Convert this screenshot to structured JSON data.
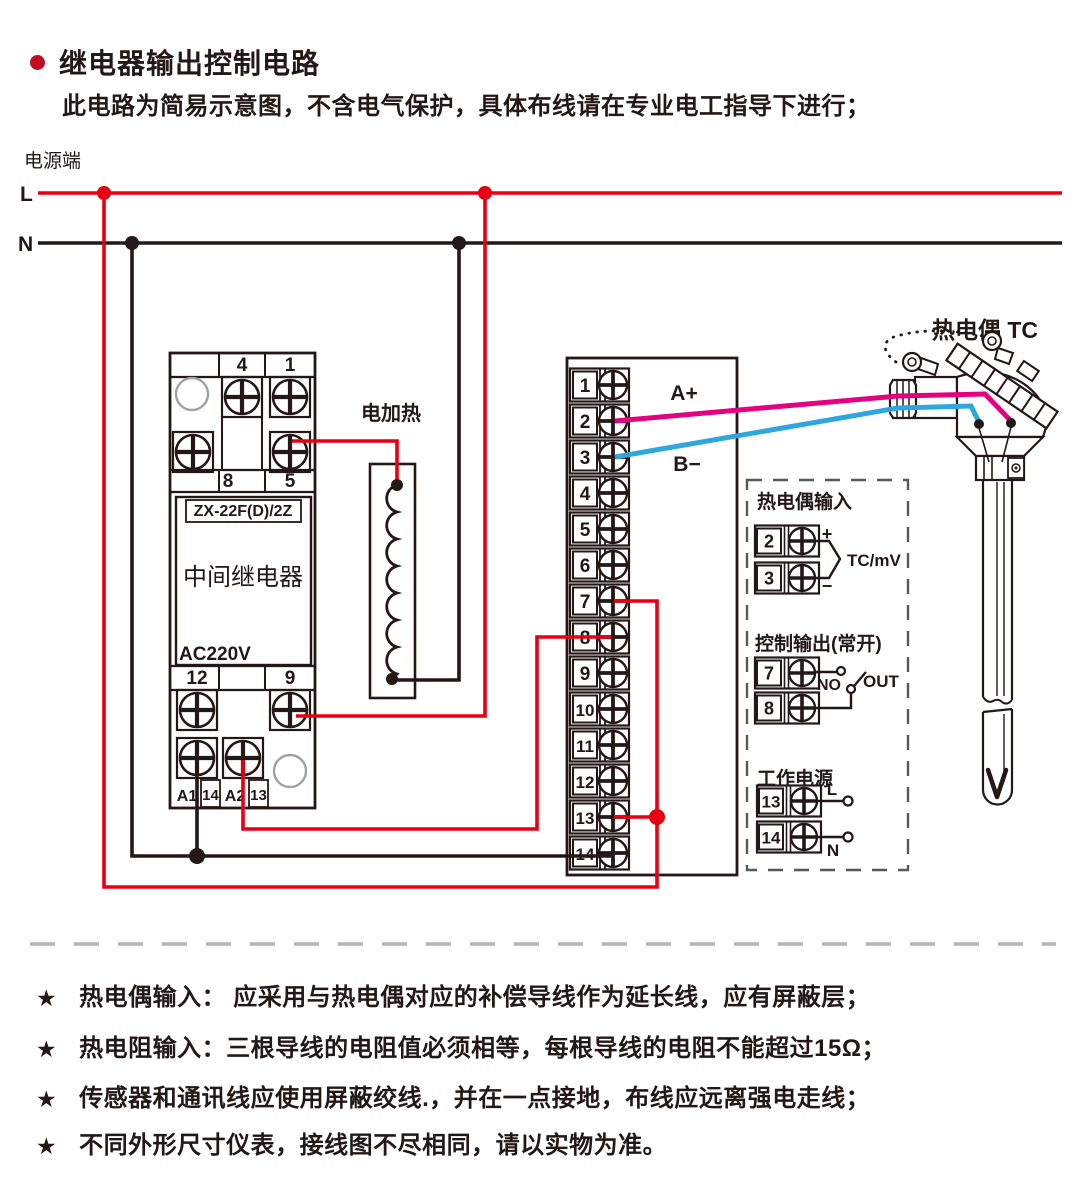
{
  "header": {
    "title": "继电器输出控制电路",
    "subtitle": "此电路为简易示意图，不含电气保护，具体布线请在专业电工指导下进行；"
  },
  "power": {
    "source_label": "电源端",
    "l": "L",
    "n": "N"
  },
  "relay": {
    "model": "ZX-22F(D)/2Z",
    "name": "中间继电器",
    "voltage": "AC220V",
    "top": [
      "4",
      "1"
    ],
    "mid": [
      "8",
      "5"
    ],
    "bottom": [
      "12",
      "9"
    ],
    "coil": [
      "A1",
      "14",
      "A2",
      "13"
    ]
  },
  "heater": {
    "label": "电加热"
  },
  "instrument": {
    "terminals": [
      "1",
      "2",
      "3",
      "4",
      "5",
      "6",
      "7",
      "8",
      "9",
      "10",
      "11",
      "12",
      "13",
      "14"
    ],
    "a_plus": "A+",
    "b_minus": "B−"
  },
  "thermocouple": {
    "label": "热电偶 TC"
  },
  "panel": {
    "tc_input": {
      "title": "热电偶输入",
      "terminals": [
        "2",
        "3"
      ],
      "plus": "+",
      "minus": "−",
      "signal": "TC/mV"
    },
    "control_output": {
      "title": "控制输出(常开)",
      "terminals": [
        "7",
        "8"
      ],
      "no": "NO",
      "out": "OUT"
    },
    "power_supply": {
      "title": "工作电源",
      "terminals": [
        "13",
        "14"
      ],
      "l": "L",
      "n": "N"
    }
  },
  "notes": {
    "star": "★",
    "items": [
      "热电偶输入： 应采用与热电偶对应的补偿导线作为延长线，应有屏蔽层；",
      "热电阻输入：三根导线的电阻值必须相等，每根导线的电阻不能超过15Ω；",
      "传感器和通讯线应使用屏蔽绞线.，并在一点接地，布线应远离强电走线；",
      "不同外形尺寸仪表，接线图不尽相同，请以实物为准。"
    ]
  },
  "colors": {
    "line_red": "#e60012",
    "line_black": "#231815",
    "wire_magenta": "#e4007f",
    "wire_blue": "#2ea7e0",
    "bullet_red": "#c30d23",
    "dash_gray": "#b5b5b6"
  }
}
